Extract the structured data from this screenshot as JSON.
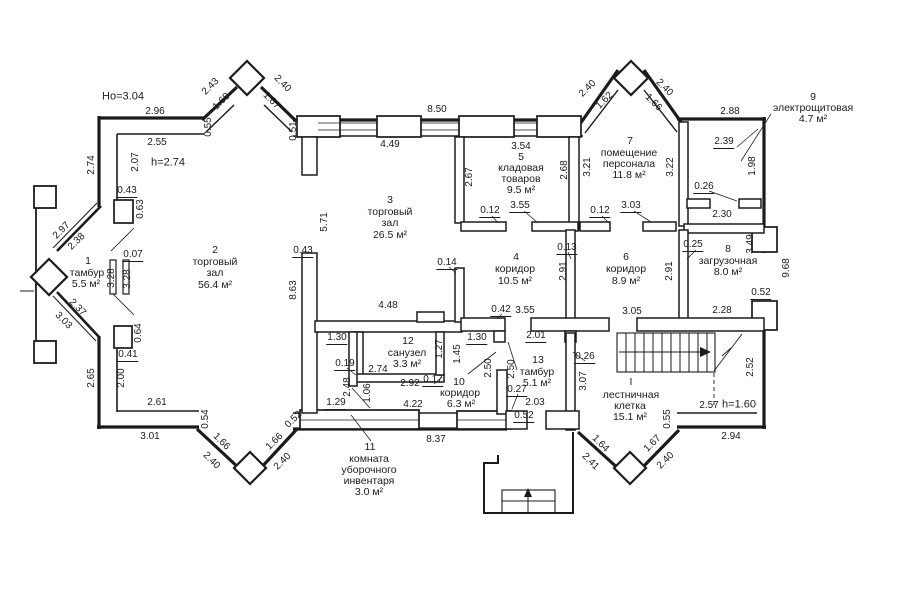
{
  "drawing": {
    "type": "floor-plan",
    "units": "m",
    "notes": {
      "floor_height": "Но=3.04",
      "ceiling_height": "h=2.74",
      "stair_note": "h=1.60"
    }
  },
  "rooms": [
    {
      "number": "1",
      "name": "тамбур",
      "area": "5.5 м²"
    },
    {
      "number": "2",
      "name": "торговый зал",
      "area": "56.4 м²"
    },
    {
      "number": "3",
      "name": "торговый зал",
      "area": "26.5 м²"
    },
    {
      "number": "4",
      "name": "коридор",
      "area": "10.5 м²"
    },
    {
      "number": "5",
      "name": "кладовая товаров",
      "area": "9.5 м²"
    },
    {
      "number": "6",
      "name": "коридор",
      "area": "8.9 м²"
    },
    {
      "number": "7",
      "name": "помещение персонала",
      "area": "11.8 м²"
    },
    {
      "number": "8",
      "name": "загрузочная",
      "area": "8.0 м²"
    },
    {
      "number": "9",
      "name": "электрощитовая",
      "area": "4.7 м²"
    },
    {
      "number": "10",
      "name": "коридор",
      "area": "6.3 м²"
    },
    {
      "number": "11",
      "name": "комната уборочного инвентаря",
      "area": "3.0 м²"
    },
    {
      "number": "12",
      "name": "санузел",
      "area": "3.3 м²"
    },
    {
      "number": "13",
      "name": "тамбур",
      "area": "5.1 м²"
    },
    {
      "number": "I",
      "name": "лестничная клетка",
      "area": "15.1 м²"
    }
  ],
  "colors": {
    "wall": "#1b1b1b",
    "background": "#ffffff",
    "text": "#1b1b1b"
  },
  "labels": [
    [
      "Но=3.04",
      123,
      97,
      0,
      "n",
      0
    ],
    [
      "2.96",
      155,
      112,
      0,
      "d",
      0
    ],
    [
      "2.43",
      211,
      87,
      -45,
      "d",
      0
    ],
    [
      "1.68",
      222,
      102,
      -45,
      "d",
      0
    ],
    [
      "2.40",
      282,
      84,
      45,
      "d",
      0
    ],
    [
      "1.67",
      271,
      101,
      45,
      "d",
      0
    ],
    [
      "0.55",
      209,
      127,
      -90,
      "d",
      0
    ],
    [
      "0.51",
      294,
      131,
      -90,
      "d",
      0
    ],
    [
      "2.55",
      157,
      143,
      0,
      "d",
      0
    ],
    [
      "h=2.74",
      168,
      163,
      0,
      "n",
      0
    ],
    [
      "2.07",
      136,
      162,
      -90,
      "d",
      0
    ],
    [
      "2.74",
      92,
      165,
      -90,
      "d",
      0
    ],
    [
      "0.43",
      127,
      192,
      0,
      "d",
      1
    ],
    [
      "0.63",
      141,
      209,
      -90,
      "d",
      0
    ],
    [
      "2.97",
      62,
      231,
      -45,
      "d",
      0
    ],
    [
      "2.38",
      77,
      242,
      -45,
      "d",
      0
    ],
    [
      "0.07",
      133,
      256,
      0,
      "d",
      1
    ],
    [
      "3.28",
      112,
      278,
      -90,
      "d",
      0
    ],
    [
      "3.28",
      128,
      279,
      -90,
      "d",
      0
    ],
    [
      "2.37",
      77,
      308,
      45,
      "d",
      0
    ],
    [
      "3.03",
      63,
      321,
      45,
      "d",
      0
    ],
    [
      "0.64",
      139,
      333,
      -90,
      "d",
      0
    ],
    [
      "0.41",
      128,
      356,
      0,
      "d",
      1
    ],
    [
      "2.00",
      122,
      378,
      -90,
      "d",
      0
    ],
    [
      "2.65",
      92,
      378,
      -90,
      "d",
      0
    ],
    [
      "2.61",
      157,
      403,
      0,
      "d",
      0
    ],
    [
      "0.54",
      206,
      419,
      -90,
      "d",
      0
    ],
    [
      "3.01",
      150,
      437,
      0,
      "d",
      0
    ],
    [
      "1.66",
      221,
      442,
      45,
      "d",
      0
    ],
    [
      "2.40",
      211,
      461,
      45,
      "d",
      0
    ],
    [
      "1.66",
      275,
      442,
      -45,
      "d",
      0
    ],
    [
      "2.40",
      283,
      462,
      -45,
      "d",
      0
    ],
    [
      "0.52",
      294,
      420,
      -45,
      "d",
      0
    ],
    [
      "1",
      88,
      261,
      0,
      "r",
      0
    ],
    [
      "тамбур",
      87,
      273,
      0,
      "r",
      0
    ],
    [
      "5.5 м²",
      86,
      284,
      0,
      "r",
      0
    ],
    [
      "2",
      215,
      250,
      0,
      "r",
      0
    ],
    [
      "торговый",
      215,
      262,
      0,
      "r",
      0
    ],
    [
      "зал",
      215,
      273,
      0,
      "r",
      0
    ],
    [
      "56.4 м²",
      215,
      285,
      0,
      "r",
      0
    ],
    [
      "8.50",
      437,
      110,
      0,
      "d",
      0
    ],
    [
      "4.49",
      390,
      145,
      0,
      "d",
      0
    ],
    [
      "5.71",
      325,
      222,
      -90,
      "d",
      0
    ],
    [
      "0.43",
      303,
      252,
      0,
      "d",
      1
    ],
    [
      "8.63",
      294,
      290,
      -90,
      "d",
      0
    ],
    [
      "3",
      390,
      200,
      0,
      "r",
      0
    ],
    [
      "торговый",
      390,
      212,
      0,
      "r",
      0
    ],
    [
      "зал",
      390,
      223,
      0,
      "r",
      0
    ],
    [
      "26.5 м²",
      390,
      235,
      0,
      "r",
      0
    ],
    [
      "2.67",
      470,
      177,
      -90,
      "d",
      0
    ],
    [
      "3.54",
      521,
      147,
      0,
      "d",
      0
    ],
    [
      "5",
      521,
      157,
      0,
      "r",
      0
    ],
    [
      "кладовая",
      521,
      168,
      0,
      "r",
      0
    ],
    [
      "товаров",
      521,
      179,
      0,
      "r",
      0
    ],
    [
      "9.5 м²",
      521,
      190,
      0,
      "r",
      0
    ],
    [
      "2.68",
      565,
      170,
      -90,
      "d",
      0
    ],
    [
      "0.12",
      490,
      212,
      0,
      "d",
      1
    ],
    [
      "3.55",
      520,
      207,
      0,
      "d",
      1
    ],
    [
      "2.40",
      588,
      89,
      -45,
      "d",
      0
    ],
    [
      "1.62",
      605,
      101,
      -45,
      "d",
      0
    ],
    [
      "2.40",
      664,
      88,
      45,
      "d",
      0
    ],
    [
      "1.66",
      653,
      103,
      45,
      "d",
      0
    ],
    [
      "3.21",
      588,
      167,
      -90,
      "d",
      0
    ],
    [
      "7",
      630,
      141,
      0,
      "r",
      0
    ],
    [
      "помещение",
      629,
      153,
      0,
      "r",
      0
    ],
    [
      "персонала",
      629,
      164,
      0,
      "r",
      0
    ],
    [
      "11.8 м²",
      629,
      175,
      0,
      "r",
      0
    ],
    [
      "3.22",
      671,
      167,
      -90,
      "d",
      0
    ],
    [
      "0.12",
      600,
      212,
      0,
      "d",
      1
    ],
    [
      "3.03",
      631,
      207,
      0,
      "d",
      1
    ],
    [
      "2.88",
      730,
      112,
      0,
      "d",
      0
    ],
    [
      "9",
      813,
      97,
      0,
      "r",
      0
    ],
    [
      "электрощитовая",
      813,
      108,
      0,
      "r",
      0
    ],
    [
      "4.7 м²",
      813,
      119,
      0,
      "r",
      0
    ],
    [
      "2.39",
      724,
      143,
      0,
      "d",
      1
    ],
    [
      "1.98",
      753,
      166,
      -90,
      "d",
      0
    ],
    [
      "0.26",
      704,
      188,
      0,
      "d",
      1
    ],
    [
      "2.30",
      722,
      215,
      0,
      "d",
      0
    ],
    [
      "0.14",
      447,
      264,
      0,
      "d",
      1
    ],
    [
      "4",
      516,
      257,
      0,
      "r",
      0
    ],
    [
      "коридор",
      515,
      269,
      0,
      "r",
      0
    ],
    [
      "10.5 м²",
      515,
      281,
      0,
      "r",
      0
    ],
    [
      "0.13",
      567,
      249,
      0,
      "d",
      1
    ],
    [
      "2.91",
      564,
      271,
      -90,
      "d",
      0
    ],
    [
      "6",
      626,
      257,
      0,
      "r",
      0
    ],
    [
      "коридор",
      626,
      269,
      0,
      "r",
      0
    ],
    [
      "8.9 м²",
      626,
      281,
      0,
      "r",
      0
    ],
    [
      "2.91",
      670,
      271,
      -90,
      "d",
      0
    ],
    [
      "0.25",
      693,
      246,
      0,
      "d",
      1
    ],
    [
      "8",
      728,
      249,
      0,
      "r",
      0
    ],
    [
      "загрузочная",
      728,
      261,
      0,
      "r",
      0
    ],
    [
      "8.0 м²",
      728,
      272,
      0,
      "r",
      0
    ],
    [
      "3.49",
      751,
      244,
      -90,
      "d",
      0
    ],
    [
      "9.68",
      787,
      268,
      -90,
      "d",
      0
    ],
    [
      "0.42",
      501,
      311,
      0,
      "d",
      1
    ],
    [
      "3.55",
      525,
      311,
      0,
      "d",
      0
    ],
    [
      "3.05",
      632,
      312,
      0,
      "d",
      0
    ],
    [
      "2.28",
      722,
      311,
      0,
      "d",
      0
    ],
    [
      "0.52",
      761,
      294,
      0,
      "d",
      1
    ],
    [
      "4.48",
      388,
      306,
      0,
      "d",
      0
    ],
    [
      "1.30",
      337,
      339,
      0,
      "d",
      1
    ],
    [
      "12",
      408,
      341,
      0,
      "r",
      0
    ],
    [
      "санузел",
      407,
      353,
      0,
      "r",
      0
    ],
    [
      "3.3 м²",
      407,
      364,
      0,
      "r",
      0
    ],
    [
      "1.27",
      440,
      349,
      -90,
      "d",
      0
    ],
    [
      "1.45",
      458,
      354,
      -90,
      "d",
      0
    ],
    [
      "1.30",
      477,
      339,
      0,
      "d",
      1
    ],
    [
      "0.19",
      345,
      365,
      0,
      "d",
      1
    ],
    [
      "2.74",
      378,
      370,
      0,
      "d",
      0
    ],
    [
      "2.92",
      410,
      384,
      0,
      "d",
      0
    ],
    [
      "0.17",
      433,
      381,
      0,
      "d",
      1
    ],
    [
      "10",
      459,
      382,
      0,
      "r",
      0
    ],
    [
      "коридор",
      460,
      393,
      0,
      "r",
      0
    ],
    [
      "6.3 м²",
      461,
      404,
      0,
      "r",
      0
    ],
    [
      "2.48",
      348,
      387,
      -90,
      "d",
      0
    ],
    [
      "1.06",
      368,
      393,
      -90,
      "d",
      0
    ],
    [
      "1.29",
      336,
      404,
      0,
      "d",
      1
    ],
    [
      "4.22",
      413,
      405,
      0,
      "d",
      0
    ],
    [
      "8.37",
      436,
      440,
      0,
      "d",
      0
    ],
    [
      "11",
      370,
      447,
      0,
      "r",
      0
    ],
    [
      "комната",
      369,
      459,
      0,
      "r",
      0
    ],
    [
      "уборочного",
      369,
      470,
      0,
      "r",
      0
    ],
    [
      "инвентаря",
      369,
      481,
      0,
      "r",
      0
    ],
    [
      "3.0 м²",
      369,
      492,
      0,
      "r",
      0
    ],
    [
      "2.50",
      489,
      368,
      -90,
      "d",
      0
    ],
    [
      "2.50",
      512,
      369,
      -90,
      "d",
      0
    ],
    [
      "2.01",
      536,
      337,
      0,
      "d",
      1
    ],
    [
      "13",
      538,
      360,
      0,
      "r",
      0
    ],
    [
      "тамбур",
      537,
      372,
      0,
      "r",
      0
    ],
    [
      "5.1 м²",
      537,
      383,
      0,
      "r",
      0
    ],
    [
      "0.26",
      585,
      358,
      0,
      "d",
      1
    ],
    [
      "3.07",
      584,
      381,
      -90,
      "d",
      0
    ],
    [
      "0.27",
      517,
      391,
      0,
      "d",
      1
    ],
    [
      "2.03",
      535,
      403,
      0,
      "d",
      0
    ],
    [
      "0.52",
      524,
      417,
      0,
      "d",
      1
    ],
    [
      "I",
      631,
      382,
      0,
      "r",
      0
    ],
    [
      "лестничная",
      631,
      395,
      0,
      "r",
      0
    ],
    [
      "клетка",
      630,
      406,
      0,
      "r",
      0
    ],
    [
      "15.1 м²",
      630,
      417,
      0,
      "r",
      0
    ],
    [
      "0.55",
      668,
      419,
      -90,
      "d",
      0
    ],
    [
      "2.52",
      751,
      367,
      -90,
      "d",
      0
    ],
    [
      "2.57",
      709,
      406,
      0,
      "d",
      0
    ],
    [
      "h=1.60",
      739,
      405,
      0,
      "n",
      0
    ],
    [
      "2.94",
      731,
      437,
      0,
      "d",
      0
    ],
    [
      "1.64",
      600,
      444,
      45,
      "d",
      0
    ],
    [
      "2.41",
      590,
      462,
      45,
      "d",
      0
    ],
    [
      "1.67",
      653,
      444,
      -45,
      "d",
      0
    ],
    [
      "2.40",
      666,
      461,
      -45,
      "d",
      0
    ]
  ]
}
